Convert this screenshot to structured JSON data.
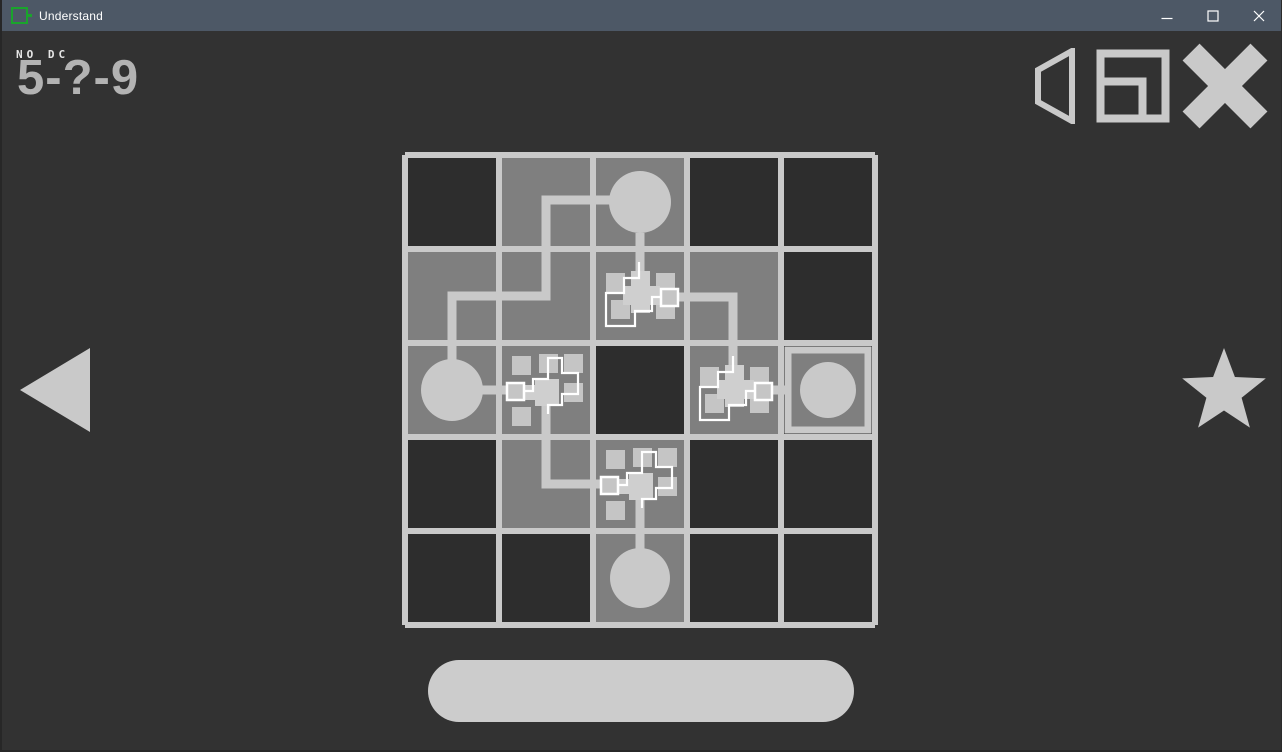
{
  "window": {
    "title": "Understand",
    "controls": [
      {
        "name": "minimize",
        "icon": "minimize-icon"
      },
      {
        "name": "maximize",
        "icon": "maximize-icon"
      },
      {
        "name": "close",
        "icon": "close-icon"
      }
    ]
  },
  "hud": {
    "rule_label": "NO DC",
    "level_id": "5-?-9",
    "top_right_icons": [
      "speaker-icon",
      "nested-square-icon",
      "x-cross-icon"
    ],
    "left_nav_icon": "left-arrow-icon",
    "right_nav_icon": "star-icon",
    "continue_label": ""
  },
  "colors": {
    "titlebar_bg": "#4d5866",
    "titlebar_text": "#ffffff",
    "app_icon_green": "#1aa42c",
    "background": "#323232",
    "cell_mid": "#7f7f7f",
    "cell_dark": "#2d2d2d",
    "light": "#c9c9c9",
    "chip": "#c5c5c5",
    "chip_core": "#cfcfcf",
    "wire_thin": "#ffffff",
    "hud_text": "#b3b3b3",
    "hud_subtext": "#e6e6e6",
    "pill": "#cccccc"
  },
  "puzzle": {
    "origin": [
      405,
      155
    ],
    "cell": 94,
    "size": 5,
    "cells": [
      [
        "dark",
        "mid",
        "mid",
        "dark",
        "dark"
      ],
      [
        "mid",
        "mid",
        "mid",
        "mid",
        "dark"
      ],
      [
        "mid",
        "mid",
        "dark",
        "mid",
        "dark"
      ],
      [
        "dark",
        "mid",
        "mid",
        "dark",
        "dark"
      ],
      [
        "dark",
        "dark",
        "mid",
        "dark",
        "dark"
      ]
    ],
    "circles": [
      {
        "col": 2,
        "row": 0,
        "r": 31
      },
      {
        "col": 0,
        "row": 2,
        "r": 31
      },
      {
        "col": 2,
        "row": 4,
        "r": 30
      },
      {
        "col": 4,
        "row": 2,
        "r": 28
      }
    ],
    "goal": {
      "col": 4,
      "row": 2,
      "inset": 7,
      "border": 7
    },
    "wires": [
      [
        [
          640,
          233
        ],
        [
          640,
          273
        ]
      ],
      [
        [
          611,
          200
        ],
        [
          546,
          200
        ],
        [
          546,
          296
        ],
        [
          452,
          296
        ],
        [
          452,
          361
        ]
      ],
      [
        [
          482,
          390
        ],
        [
          512,
          390
        ]
      ],
      [
        [
          546,
          405
        ],
        [
          546,
          484
        ],
        [
          606,
          484
        ]
      ],
      [
        [
          640,
          497
        ],
        [
          640,
          550
        ]
      ],
      [
        [
          675,
          297
        ],
        [
          733,
          297
        ],
        [
          733,
          366
        ]
      ],
      [
        [
          770,
          390
        ],
        [
          803,
          390
        ]
      ]
    ],
    "clusters": [
      {
        "cell": [
          2,
          1
        ],
        "orient": "right"
      },
      {
        "cell": [
          3,
          2
        ],
        "orient": "right"
      },
      {
        "cell": [
          1,
          2
        ],
        "orient": "left"
      },
      {
        "cell": [
          2,
          3
        ],
        "orient": "left"
      }
    ],
    "cluster_shapes": {
      "right": {
        "squares": [
          [
            13,
            24,
            19
          ],
          [
            63,
            24,
            19
          ],
          [
            18,
            51,
            19
          ],
          [
            63,
            51,
            19
          ]
        ],
        "plus": [
          [
            38,
            22,
            19,
            42
          ],
          [
            30,
            37,
            37,
            19
          ],
          [
            55,
            41,
            14,
            15
          ]
        ],
        "wire": [
          [
            46,
            13
          ],
          [
            46,
            29
          ],
          [
            31,
            29
          ],
          [
            31,
            44
          ],
          [
            13,
            44
          ],
          [
            13,
            77
          ],
          [
            42,
            77
          ],
          [
            42,
            62
          ],
          [
            59,
            62
          ],
          [
            59,
            48
          ],
          [
            69,
            48
          ]
        ],
        "connector": [
          68,
          40,
          17
        ]
      },
      "left": {
        "squares": [
          [
            13,
            13,
            19
          ],
          [
            40,
            11,
            19
          ],
          [
            65,
            11,
            19
          ],
          [
            65,
            40,
            19
          ],
          [
            13,
            64,
            19
          ]
        ],
        "plus": [
          [
            36,
            36,
            24,
            27
          ],
          [
            24,
            42,
            14,
            15
          ]
        ],
        "wire": [
          [
            25,
            48
          ],
          [
            34,
            48
          ],
          [
            34,
            36
          ],
          [
            49,
            36
          ],
          [
            49,
            15
          ],
          [
            63,
            15
          ],
          [
            63,
            30
          ],
          [
            79,
            30
          ],
          [
            79,
            51
          ],
          [
            63,
            51
          ],
          [
            63,
            62
          ],
          [
            49,
            62
          ],
          [
            49,
            71
          ]
        ],
        "connector": [
          8,
          40,
          17
        ]
      }
    }
  }
}
